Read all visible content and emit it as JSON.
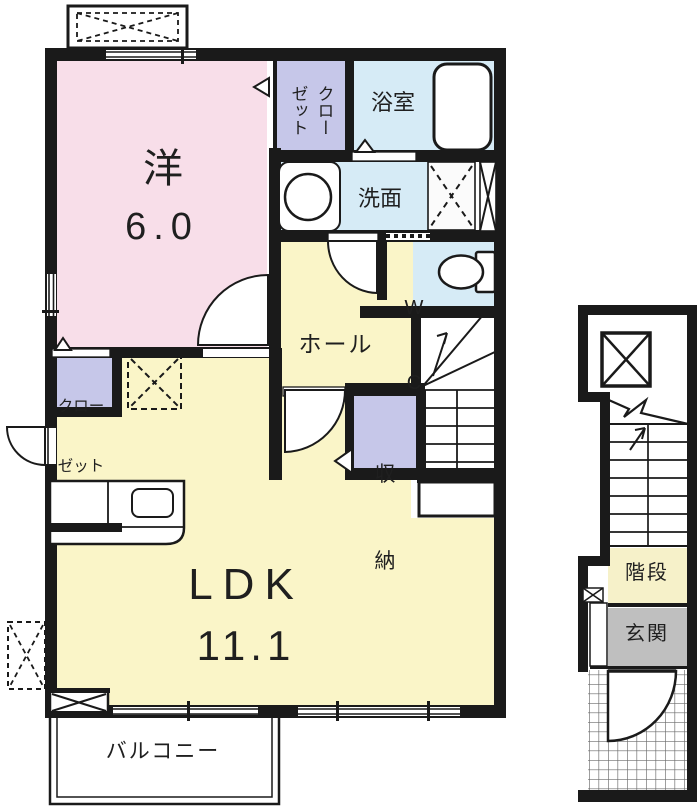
{
  "plan": {
    "rooms": {
      "western": {
        "name": "洋",
        "size": "6.0"
      },
      "closet_top": {
        "line1": "クロー",
        "line2": "ゼット"
      },
      "bathroom": {
        "name": "浴室"
      },
      "washroom": {
        "name": "洗面"
      },
      "wc": {
        "line1": "W",
        "line2": "C"
      },
      "hall": {
        "name": "ホール"
      },
      "storage": {
        "line1": "収",
        "line2": "納"
      },
      "closet_lower": {
        "line1": "クロー",
        "line2": "ゼット"
      },
      "ldk": {
        "name": "LDK",
        "size": "11.1"
      },
      "balcony": {
        "name": "バルコニー"
      },
      "stair_hall": {
        "name": "階段"
      },
      "entrance": {
        "name": "玄関"
      }
    },
    "colors": {
      "wall": "#1a1a1a",
      "western_room": "#f8dee9",
      "closet": "#c6c7e9",
      "wet_area": "#d6ebf6",
      "living": "#faf5c8",
      "stair_hall": "#f6f1c9",
      "entrance": "#bfbfbf"
    }
  }
}
